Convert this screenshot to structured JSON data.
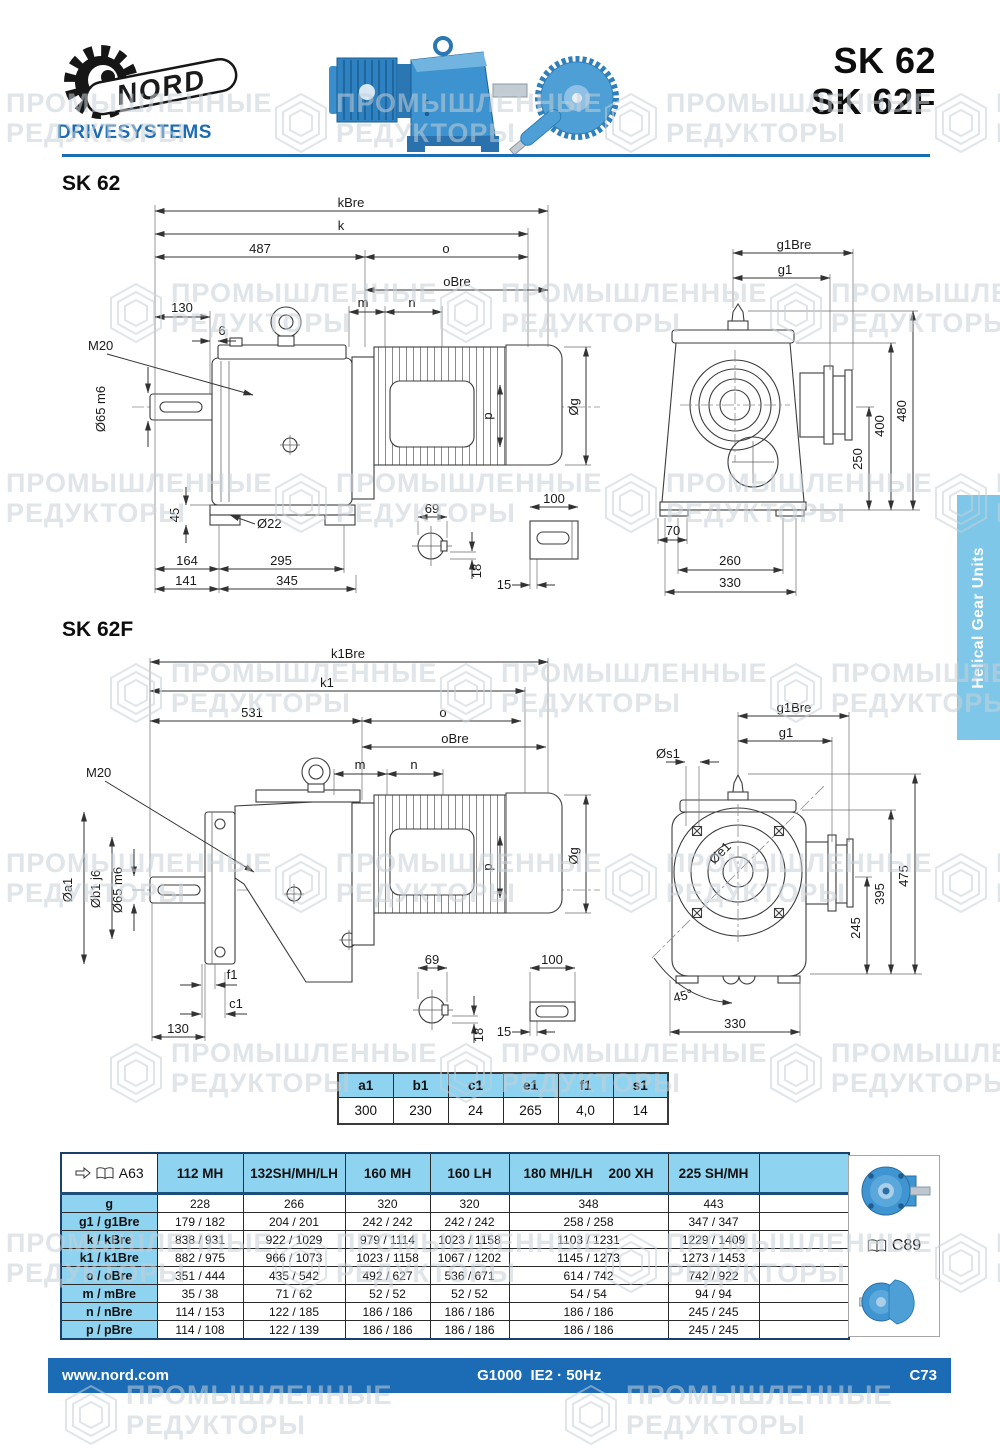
{
  "page": {
    "brand": "NORD",
    "brand_sub": "DRIVESYSTEMS",
    "title_lines": [
      "SK 62",
      "SK 62F"
    ]
  },
  "watermark": {
    "line1": "ПРОМЫШЛЕННЫЕ",
    "line2": "РЕДУКТОРЫ",
    "positions": [
      [
        -60,
        88
      ],
      [
        270,
        88
      ],
      [
        600,
        88
      ],
      [
        930,
        88
      ],
      [
        105,
        278
      ],
      [
        435,
        278
      ],
      [
        765,
        278
      ],
      [
        -60,
        468
      ],
      [
        270,
        468
      ],
      [
        600,
        468
      ],
      [
        930,
        468
      ],
      [
        105,
        658
      ],
      [
        435,
        658
      ],
      [
        765,
        658
      ],
      [
        -60,
        848
      ],
      [
        270,
        848
      ],
      [
        600,
        848
      ],
      [
        930,
        848
      ],
      [
        105,
        1038
      ],
      [
        435,
        1038
      ],
      [
        765,
        1038
      ],
      [
        -60,
        1228
      ],
      [
        270,
        1228
      ],
      [
        600,
        1228
      ],
      [
        930,
        1228
      ],
      [
        60,
        1380
      ],
      [
        560,
        1380
      ]
    ]
  },
  "sidebar": {
    "label": "Helical Gear Units"
  },
  "sk62": {
    "title": "SK 62",
    "side": {
      "kBre": "kBre",
      "k": "k",
      "d487": "487",
      "o": "o",
      "oBre": "oBre",
      "d130": "130",
      "d6": "6",
      "m": "m",
      "n": "n",
      "M20": "M20",
      "shaft": "Ø65 m6",
      "p": "p",
      "g": "Øg",
      "d45": "45",
      "d22": "Ø22",
      "d164": "164",
      "d295": "295",
      "d141": "141",
      "d345": "345",
      "d69": "69",
      "d18": "18",
      "d100": "100",
      "d15": "15"
    },
    "end": {
      "g1Bre": "g1Bre",
      "g1": "g1",
      "d480": "480",
      "d400": "400",
      "d250": "250",
      "d70": "70",
      "d260": "260",
      "d330": "330"
    }
  },
  "sk62f": {
    "title": "SK 62F",
    "side": {
      "k1Bre": "k1Bre",
      "k1": "k1",
      "d531": "531",
      "o": "o",
      "oBre": "oBre",
      "m": "m",
      "n": "n",
      "M20": "M20",
      "a1": "Øa1",
      "b1": "Øb1 j6",
      "shaft": "Ø65 m6",
      "p": "p",
      "g": "Øg",
      "f1": "f1",
      "c1": "c1",
      "d130": "130",
      "d69": "69",
      "d18": "18",
      "d100": "100",
      "d15": "15"
    },
    "end": {
      "g1Bre": "g1Bre",
      "g1": "g1",
      "s1": "Øs1",
      "e1": "Øe1",
      "d475": "475",
      "d395": "395",
      "d245": "245",
      "angle": "45°",
      "d330": "330"
    }
  },
  "small_table": {
    "headers": [
      "a1",
      "b1",
      "c1",
      "e1",
      "f1",
      "s1"
    ],
    "values": [
      "300",
      "230",
      "24",
      "265",
      "4,0",
      "14"
    ]
  },
  "main_table": {
    "ref_label": "A63",
    "columns": [
      "112 MH",
      "132SH/MH/LH",
      "160 MH",
      "160 LH",
      "180 MH/LH",
      "200 XH",
      "225 SH/MH"
    ],
    "rows": [
      {
        "label": "g",
        "values": [
          "228",
          "266",
          "320",
          "320",
          "348",
          "443"
        ]
      },
      {
        "label": "g1 / g1Bre",
        "values": [
          "179 / 182",
          "204 / 201",
          "242 / 242",
          "242 / 242",
          "258 / 258",
          "347 / 347"
        ]
      },
      {
        "label": "k / kBre",
        "values": [
          "838 / 931",
          "922 / 1029",
          "979 / 1114",
          "1023 / 1158",
          "1103 / 1231",
          "1229 / 1409"
        ]
      },
      {
        "label": "k1 / k1Bre",
        "values": [
          "882 / 975",
          "966 / 1073",
          "1023 / 1158",
          "1067 / 1202",
          "1145 / 1273",
          "1273 / 1453"
        ]
      },
      {
        "label": "o / oBre",
        "values": [
          "351 / 444",
          "435 / 542",
          "492 / 627",
          "536 / 671",
          "614 / 742",
          "742 / 922"
        ]
      },
      {
        "label": "m / mBre",
        "values": [
          "35 / 38",
          "71 / 62",
          "52 / 52",
          "52 / 52",
          "54 / 54",
          "94 / 94"
        ]
      },
      {
        "label": "n / nBre",
        "values": [
          "114 / 153",
          "122 / 185",
          "186 / 186",
          "186 / 186",
          "186 / 186",
          "245 / 245"
        ]
      },
      {
        "label": "p / pBre",
        "values": [
          "114 / 108",
          "122 / 139",
          "186 / 186",
          "186 / 186",
          "186 / 186",
          "245 / 245"
        ]
      }
    ]
  },
  "side_ref": {
    "label": "C89"
  },
  "footer": {
    "site": "www.nord.com",
    "center": "G1000  IE2 · 50Hz",
    "page": "C73"
  },
  "colors": {
    "brand_blue": "#1b6cb5",
    "light_blue": "#8ed3ef",
    "tab_blue": "#7ec7e8",
    "watermark_gray": "#c7cfd7"
  }
}
